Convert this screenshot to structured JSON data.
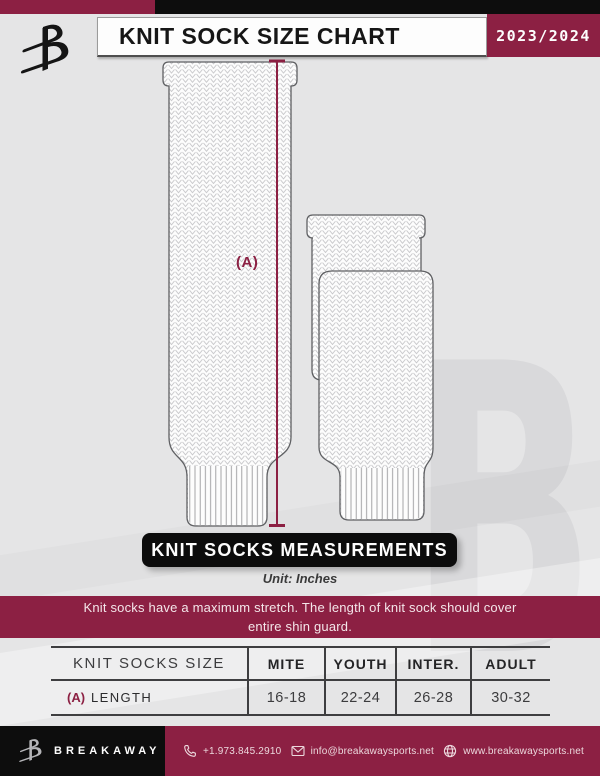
{
  "header": {
    "title": "KNIT SOCK SIZE CHART",
    "season": "2023/2024"
  },
  "diagram": {
    "measure_label": "(A)"
  },
  "section": {
    "banner": "KNIT SOCKS MEASUREMENTS",
    "unit": "Unit: Inches",
    "notice_line1": "Knit socks have a maximum stretch. The length of knit sock should cover",
    "notice_line2": "entire shin guard."
  },
  "table": {
    "headers": [
      "KNIT SOCKS SIZE",
      "MITE",
      "YOUTH",
      "INTER.",
      "ADULT"
    ],
    "row": {
      "prefix": "(A)",
      "label": "LENGTH",
      "values": [
        "16-18",
        "22-24",
        "26-28",
        "30-32"
      ]
    }
  },
  "footer": {
    "brand": "BREAKAWAY",
    "phone": "+1.973.845.2910",
    "email": "info@breakawaysports.net",
    "website": "www.breakawaysports.net"
  },
  "colors": {
    "maroon": "#8c2043",
    "black": "#0d0d0d",
    "background": "#e5e5e6",
    "watermark": "#d9d9db"
  },
  "watermark_letter": "B"
}
